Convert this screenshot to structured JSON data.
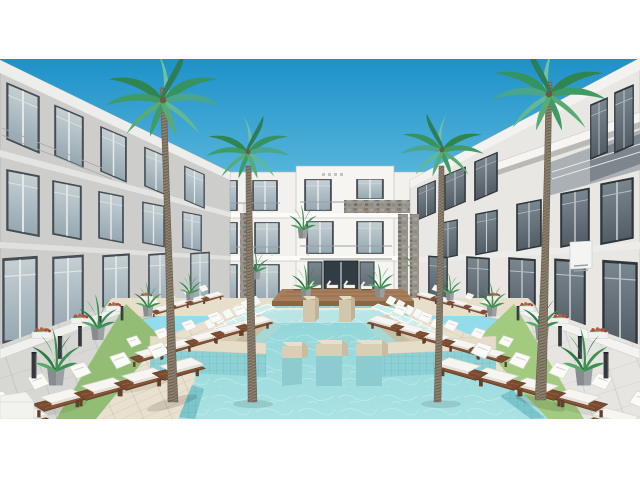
{
  "scene": {
    "kind": "architectural-3d-rendering",
    "subject": "resort apartment courtyard with central swimming pool",
    "letterbox": "white bands top and bottom",
    "objects": {
      "buildings": 3,
      "palm_trees": 4,
      "pool": 1,
      "in_pool_platforms": 6,
      "step_terraces_sides": 2,
      "deck_lounge_chair_rows_per_side": 3,
      "in_pool_lounger_rows": 2,
      "potted_plants": 12,
      "light_bollards": 12,
      "flower_boxes": 8
    }
  },
  "palette": {
    "sky_top": "#1e91c9",
    "sky_horizon": "#93dcee",
    "water_far": "#8fd4d8",
    "water_near": "#a9e2e2",
    "pool_tile": "#7cc6cb",
    "coping": "#e6ddc8",
    "step_sand": "#d9cfb5",
    "platform_tan": "#d9cfb4",
    "deck_wood": "#e9e1cf",
    "deck_far": "#e7dfcc",
    "grass": "#9cc67c",
    "grass_shade": "#93bd74",
    "pavement": "#d7d7d3",
    "building_white": "#f2f1ee",
    "building_shade": "#cdcdcb",
    "building_sun": "#e8e7e4",
    "fascia": "#efeeec",
    "glass_light": "#b9c4c9",
    "glass_dark": "#66727b",
    "window_frame": "#3d464d",
    "stone_accent": "#98948b",
    "platform_wood_top": "#a87f5c",
    "platform_wood_front": "#8a6744",
    "cushion_white": "#f6f5f1",
    "lounger_wood": "#7b4b31",
    "palm_trunk": "#8d8170",
    "frond_green": "#3f9a64",
    "frond_teal": "#6fc0a4",
    "plant_green": "#3e8f52",
    "flower_red": "#c94038",
    "bollard_dark": "#35393e",
    "letterbox_white": "#ffffff"
  }
}
